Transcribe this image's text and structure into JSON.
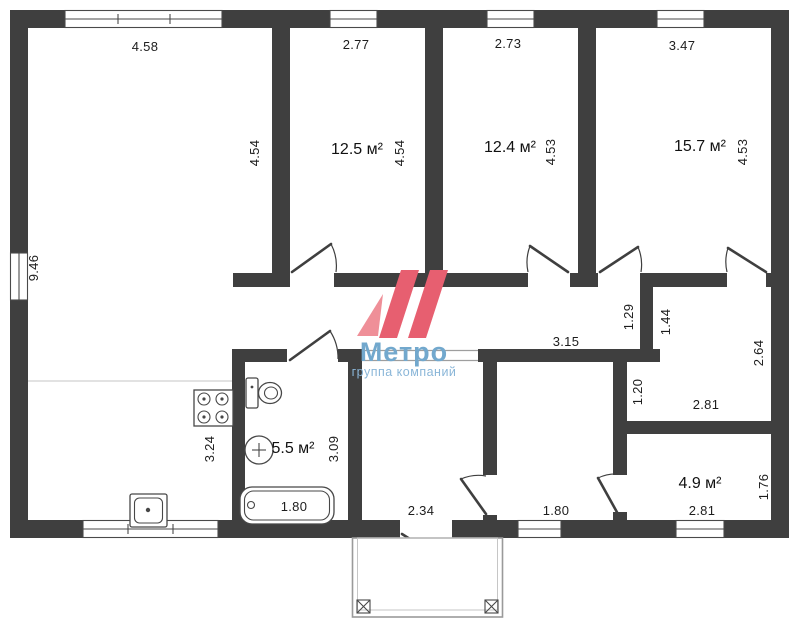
{
  "plan": {
    "type": "floor-plan",
    "wall_color": "#3f3f3f",
    "areas": {
      "bedroom1": "12.5 м²",
      "bedroom2": "12.4 м²",
      "bedroom3": "15.7 м²",
      "bathroom": "5.5 м²",
      "back_room": "4.9 м²"
    },
    "dims": {
      "living_width": "4.58",
      "bedroom1_width": "2.77",
      "bedroom2_width": "2.73",
      "bedroom3_width": "3.47",
      "living_height": "9.46",
      "living_inner_height": "4.54",
      "bedroom1_height": "4.54",
      "bedroom2_height": "4.53",
      "bedroom3_height": "4.53",
      "corridor_length": "3.15",
      "corridor_height": "1.29",
      "closet_upper_height": "1.44",
      "closet_total_height": "2.64",
      "closet_lower_height": "1.20",
      "closet_width": "2.81",
      "kitchen_zone_height": "3.24",
      "bathroom_height": "3.09",
      "bathroom_width": "1.80",
      "hall_width": "2.34",
      "middle_room_width": "1.80",
      "back_room_width": "2.81",
      "back_room_height": "1.76"
    },
    "fixtures": [
      "stove-icon",
      "toilet-icon",
      "washbasin-icon",
      "bathtub-icon",
      "kitchen-sink-icon",
      "entrance-porch"
    ]
  },
  "watermark": {
    "brand": "Метро",
    "subtitle": "группа компаний",
    "logo_color": "#e75f70",
    "logo_light_color": "#ef8f98",
    "text_color": "#72a8cd"
  }
}
